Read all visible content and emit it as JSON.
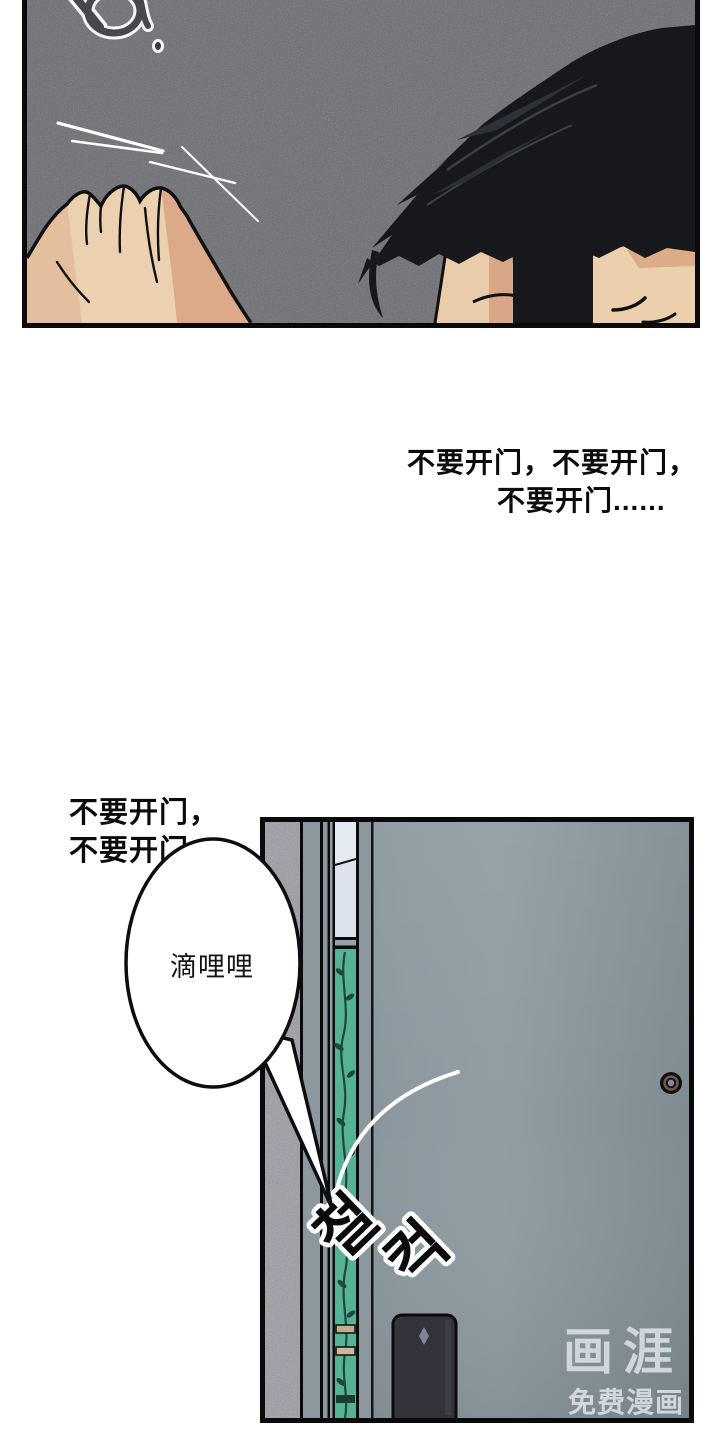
{
  "page": {
    "background": "#ffffff"
  },
  "panels": {
    "top_panel": {
      "background_color": "#6b6c70",
      "border_color": "#0a0a0c"
    },
    "door_panel": {
      "border_color": "#0a0a0c",
      "wall_color": "#9a9ba3",
      "frame_color": "#8c989e",
      "door_color": "#87939a",
      "window_color": "#dce3ec",
      "plant_strip_color": "#56b295",
      "keypad_color": "#32323a"
    }
  },
  "character": {
    "hair_color": "#17181c",
    "skin_light": "#ecd2b0",
    "skin_shadow": "#dcaa89"
  },
  "monologue_main": {
    "line1": "不要开门，不要开门，",
    "line2": "不要开门......"
  },
  "monologue_small": {
    "line1": "不要开门，",
    "line2": "不要开门，"
  },
  "speech_bubble": {
    "text": "滴哩哩"
  },
  "sfx": {
    "char1": "철",
    "char2": "컥"
  },
  "watermark": {
    "logo": "画涯",
    "tagline": "免费漫画",
    "color": "#d9dfe7"
  }
}
